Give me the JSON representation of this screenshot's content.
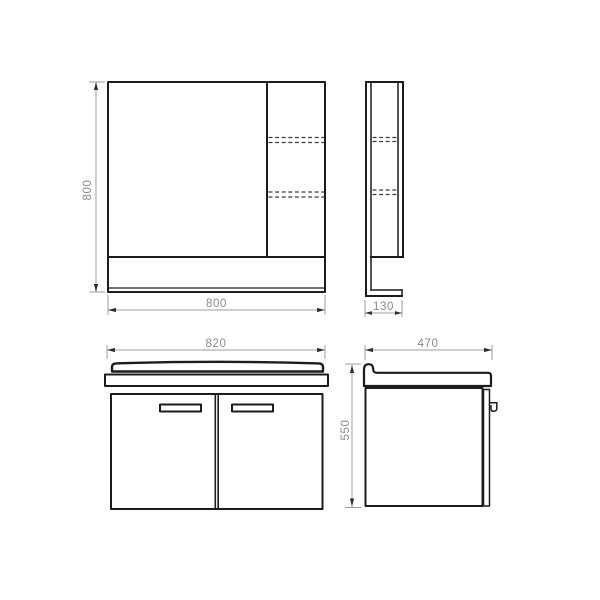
{
  "drawing": {
    "colors": {
      "background": "#ffffff",
      "line": "#1c1c1c",
      "dash": "#3f3f3f",
      "dim_line": "#9c9c9c",
      "dim_text": "#8a8a8a",
      "arrow": "#2e2e2e"
    },
    "views": {
      "mirror_front": {
        "width_label": "800",
        "height_label": "800"
      },
      "mirror_side": {
        "depth_label": "130"
      },
      "vanity_front": {
        "width_label": "820"
      },
      "vanity_side": {
        "depth_label": "470",
        "height_label": "550"
      }
    }
  }
}
